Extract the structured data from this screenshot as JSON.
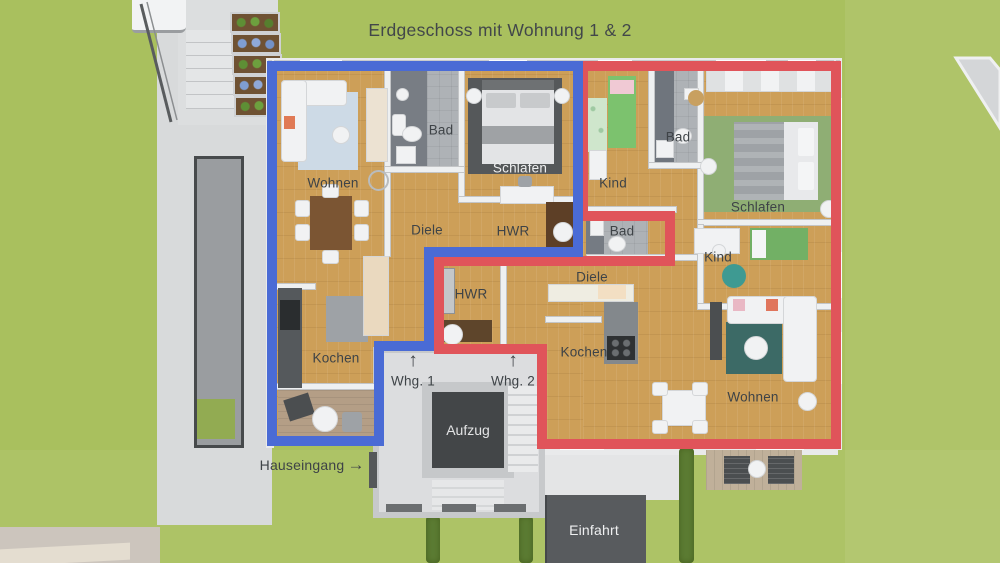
{
  "title": "Erdgeschoss mit Wohnung 1 & 2",
  "colors": {
    "apartment1_outline": "#4a6bd5",
    "apartment2_outline": "#e0545a",
    "lawn": "#a9c05e",
    "wood_floor": "#cd9f58",
    "walkway": "#d8dadb",
    "driveway": "#585b5e",
    "elevator_box": "#434648"
  },
  "apartment1": {
    "outline_color": "#4a6bd5",
    "entrance_label": "Whg. 1",
    "rooms": [
      {
        "label": "Wohnen"
      },
      {
        "label": "Bad"
      },
      {
        "label": "Schlafen"
      },
      {
        "label": "Diele"
      },
      {
        "label": "HWR"
      },
      {
        "label": "Kochen"
      }
    ]
  },
  "apartment2": {
    "outline_color": "#e0545a",
    "entrance_label": "Whg. 2",
    "rooms": [
      {
        "label": "Kind"
      },
      {
        "label": "Bad"
      },
      {
        "label": "Schlafen"
      },
      {
        "label": "Bad"
      },
      {
        "label": "Kind"
      },
      {
        "label": "Diele"
      },
      {
        "label": "HWR"
      },
      {
        "label": "Kochen"
      },
      {
        "label": "Wohnen"
      }
    ]
  },
  "common_areas": {
    "elevator_label": "Aufzug",
    "house_entrance_label": "Hauseingang",
    "driveway_label": "Einfahrt"
  },
  "icons": {
    "up_arrow": "↑",
    "right_arrow": "→"
  }
}
